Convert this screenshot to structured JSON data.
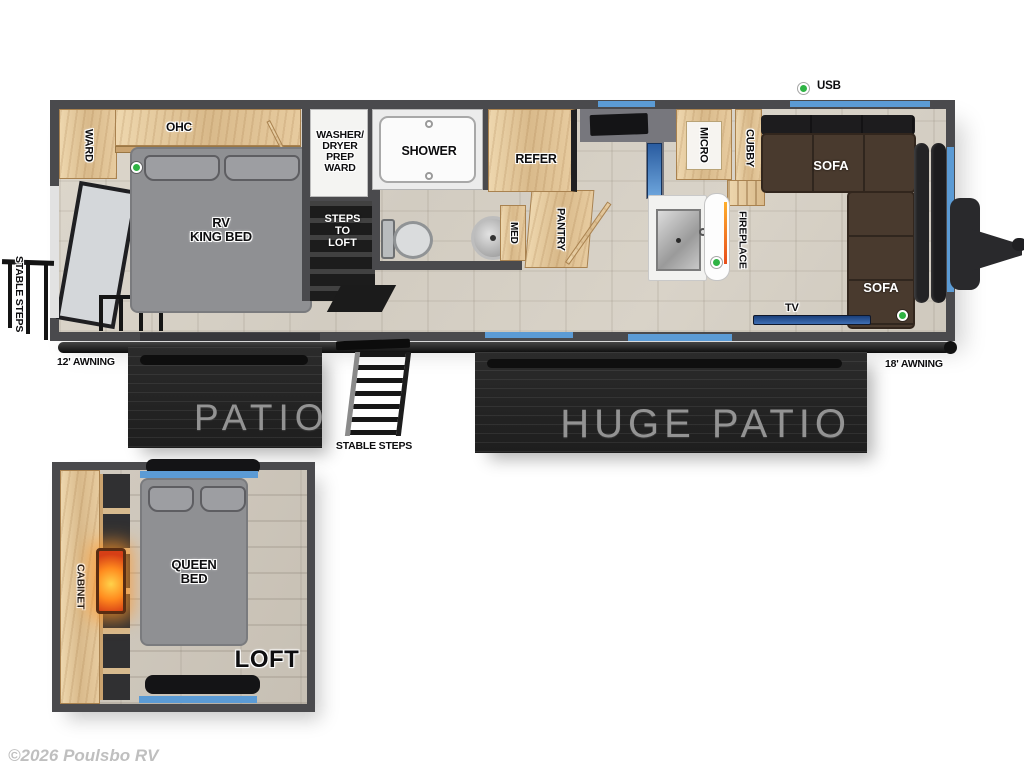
{
  "watermark": "©2026 Poulsbo RV",
  "main_floor": {
    "stable_steps_side_label": "STABLE STEPS",
    "usb_label": "USB",
    "rooms": {
      "ward": "WARD",
      "ohc": "OHC",
      "king_bed": "RV\nKING BED",
      "washer_dryer_prep_ward": "WASHER/\nDRYER\nPREP\nWARD",
      "steps_to_loft": "STEPS\nTO\nLOFT",
      "shower": "SHOWER",
      "med": "MED",
      "pantry": "PANTRY",
      "refer": "REFER",
      "micro": "MICRO",
      "cubby": "CUBBY",
      "fireplace": "FIREPLACE",
      "sofa_front": "SOFA",
      "sofa_side": "SOFA",
      "tv": "TV"
    }
  },
  "exterior": {
    "awning_12": "12' AWNING",
    "awning_18": "18' AWNING",
    "patio": "PATIO",
    "huge_patio": "HUGE PATIO",
    "stable_steps": "STABLE STEPS"
  },
  "loft": {
    "cabinet": "CABINET",
    "queen_bed": "QUEEN\nBED",
    "name": "LOFT"
  },
  "colors": {
    "wall": "#4a4a4d",
    "wood": "#e3c79c",
    "floor": "#d7d1c6",
    "bed": "#8f9093",
    "sofa": "#493a2e",
    "window": "#5b9bd5",
    "green": "#2fb344",
    "deck": "#242424",
    "deck_text": "#939393",
    "range_blue": "#3c6fb2",
    "fire_orange": "#ff8a1e"
  }
}
